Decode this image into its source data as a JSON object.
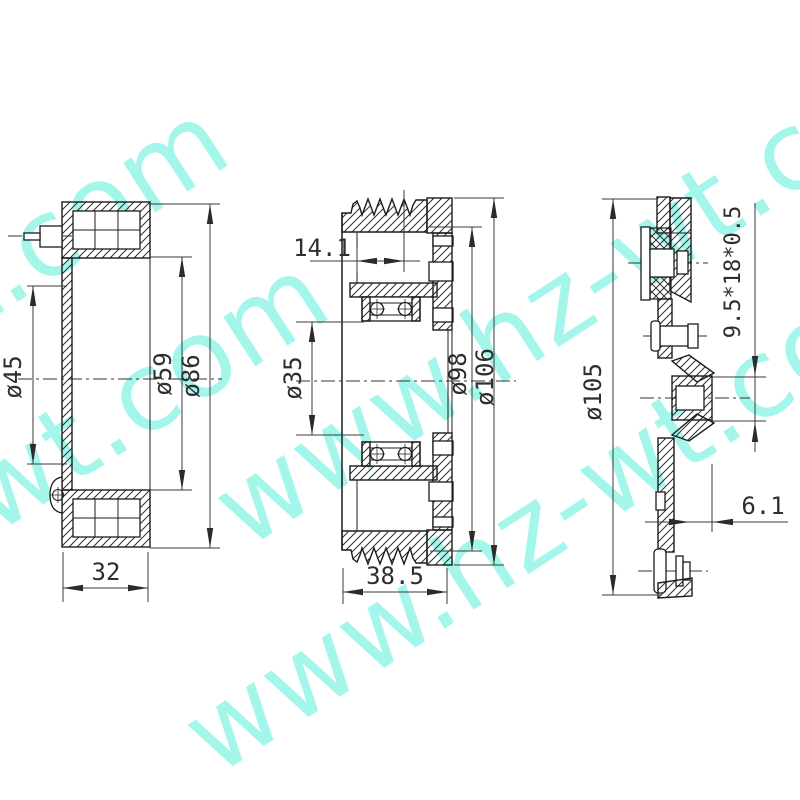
{
  "watermark": {
    "text": "www.hz-wt.com",
    "color": "#5af0dc"
  },
  "drawing": {
    "line_color": "#1c1c1c",
    "background": "#ffffff",
    "views": [
      {
        "id": "coil-side-section",
        "dims": {
          "d45": "ø45",
          "d59": "ø59",
          "d86": "ø86",
          "w32": "32"
        }
      },
      {
        "id": "pulley-section",
        "dims": {
          "w141": "14.1",
          "d35": "ø35",
          "d98": "ø98",
          "d106": "ø106",
          "w385": "38.5"
        }
      },
      {
        "id": "hub-plate-section",
        "dims": {
          "rivet": "9.5*18*0.5",
          "d105": "ø105",
          "w61": "6.1"
        }
      }
    ]
  }
}
